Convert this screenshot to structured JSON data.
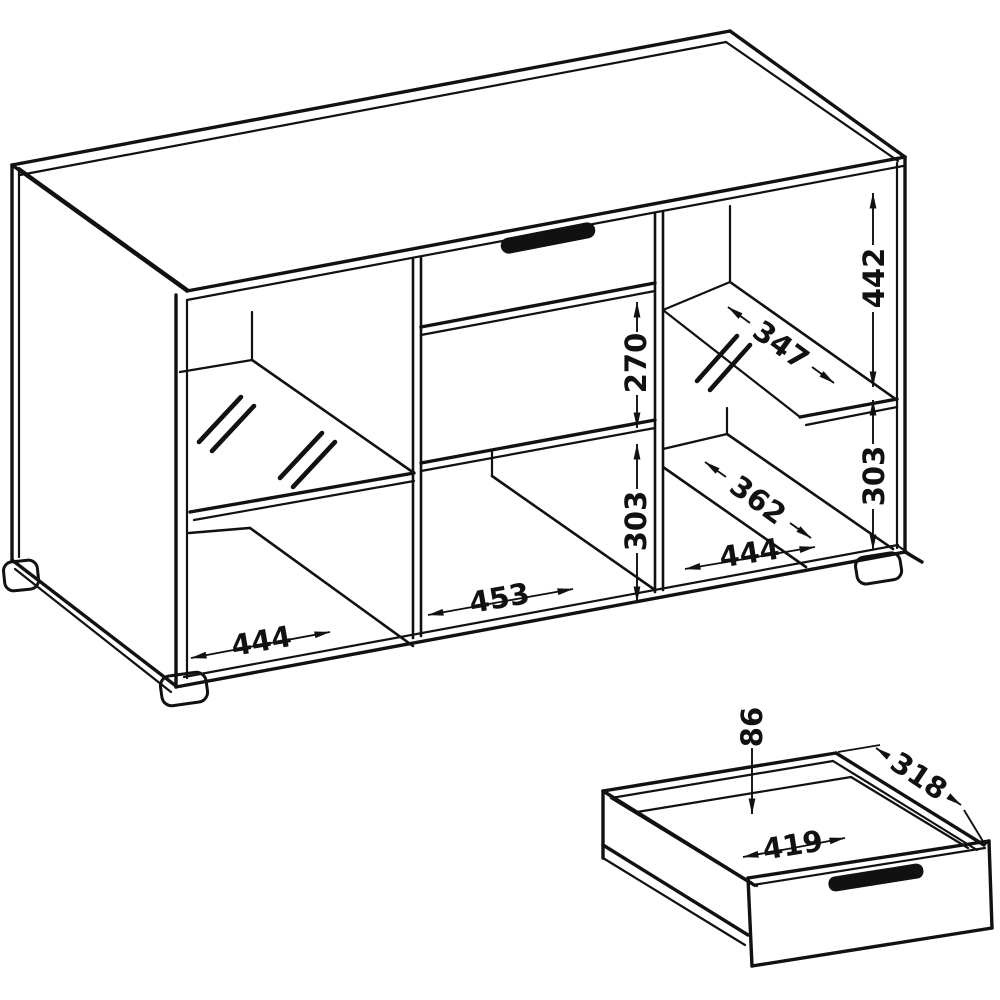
{
  "drawing": {
    "cabinet_view": {
      "vertical_dims": {
        "right_upper": "442",
        "right_lower": "303",
        "middle_upper": "270",
        "middle_lower": "303"
      },
      "width_dims": {
        "left_bay": "444",
        "middle_bay": "453",
        "right_bay": "444"
      },
      "depth_dims": {
        "upper_glass_shelf": "347",
        "lower_right_shelf": "362"
      }
    },
    "drawer_view": {
      "height": "86",
      "depth": "318",
      "inner_width": "419"
    },
    "style": {
      "line_color": "#111111",
      "background": "#ffffff",
      "handle_color": "#111111"
    }
  }
}
